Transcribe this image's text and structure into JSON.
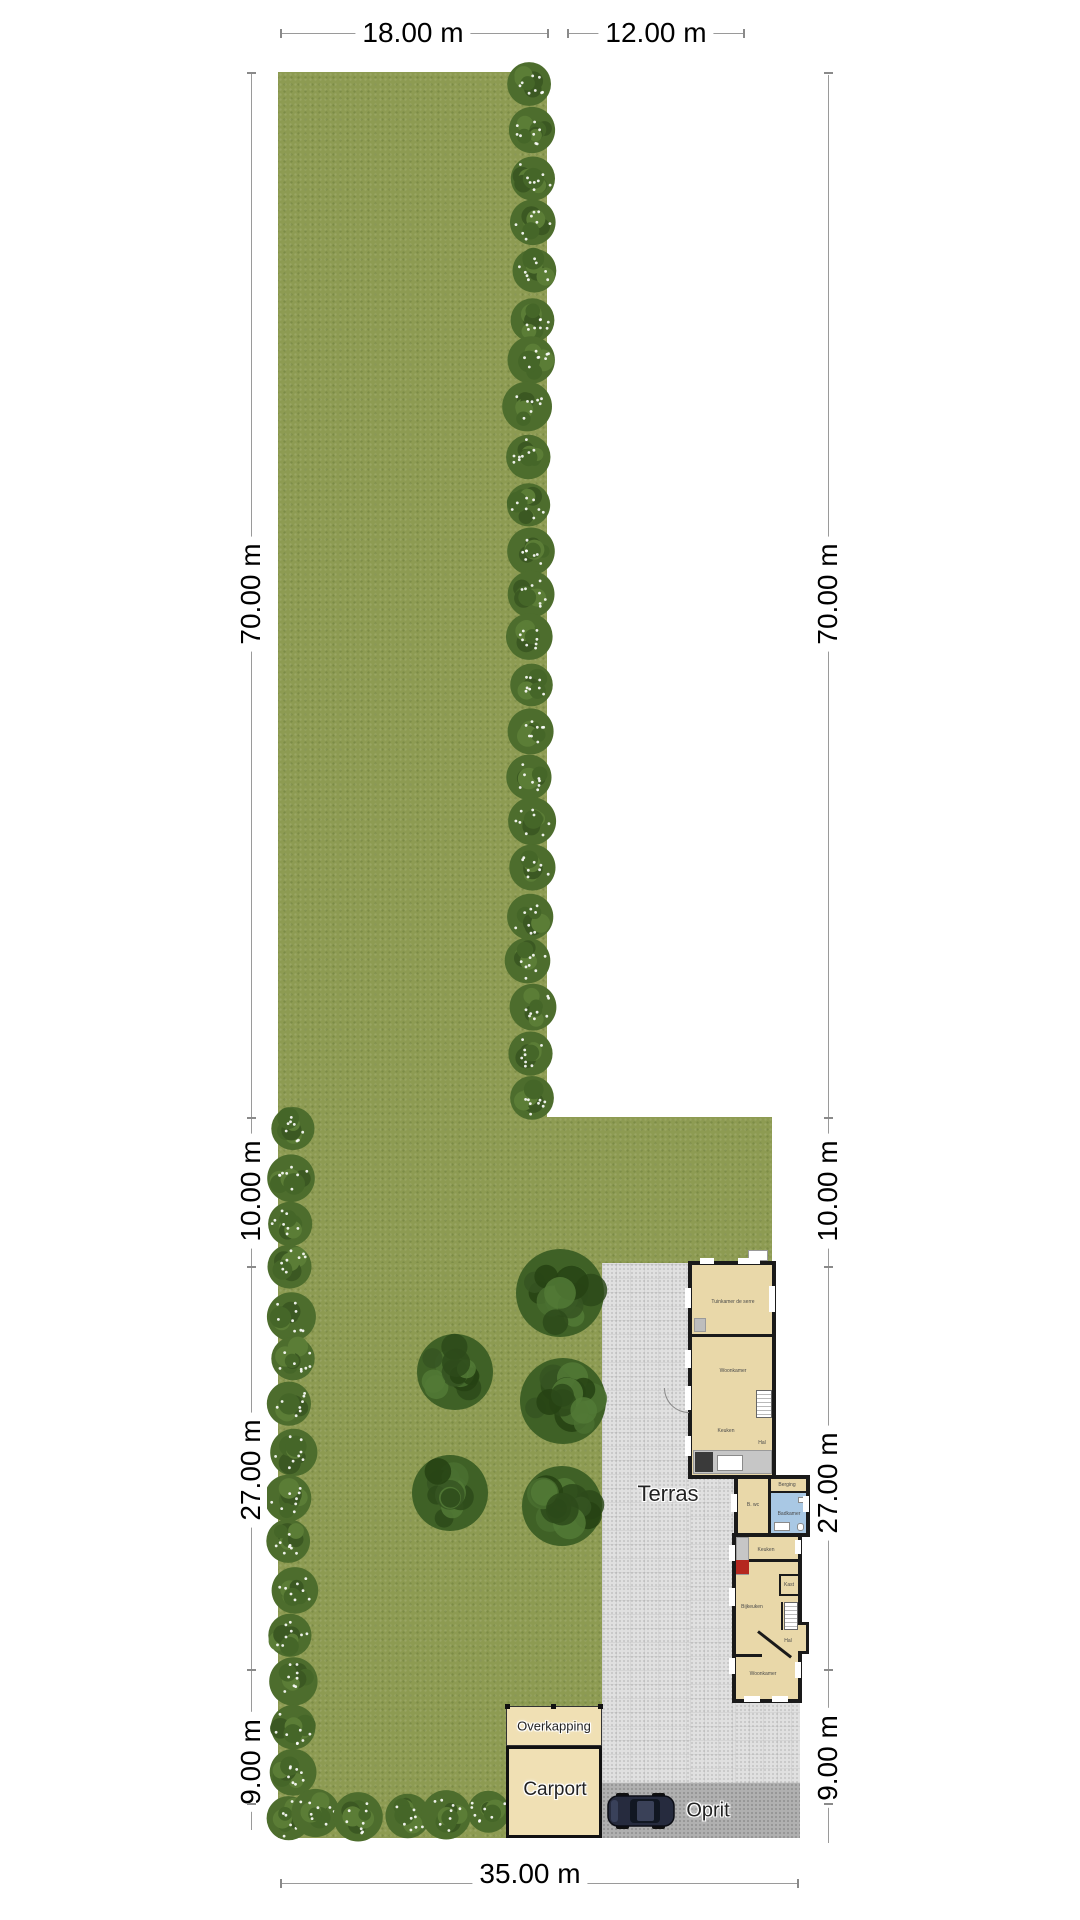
{
  "dimensions": {
    "top": [
      {
        "text": "18.00 m",
        "cx": 413,
        "cy": 33
      },
      {
        "text": "12.00 m",
        "cx": 656,
        "cy": 33
      }
    ],
    "left": [
      {
        "text": "70.00 m",
        "cx": 251,
        "cy": 594
      },
      {
        "text": "10.00 m",
        "cx": 251,
        "cy": 1191
      },
      {
        "text": "27.00 m",
        "cx": 251,
        "cy": 1470
      },
      {
        "text": "9.00 m",
        "cx": 251,
        "cy": 1762
      }
    ],
    "right": [
      {
        "text": "70.00 m",
        "cx": 828,
        "cy": 594
      },
      {
        "text": "10.00 m",
        "cx": 828,
        "cy": 1191
      },
      {
        "text": "27.00 m",
        "cx": 828,
        "cy": 1483
      },
      {
        "text": "9.00 m",
        "cx": 828,
        "cy": 1758
      }
    ],
    "bottom": [
      {
        "text": "35.00 m",
        "cx": 530,
        "cy": 1874
      }
    ]
  },
  "areas": {
    "terras": {
      "text": "Terras",
      "cx": 668,
      "cy": 1494,
      "size": 22
    },
    "oprit": {
      "text": "Oprit",
      "cx": 708,
      "cy": 1811,
      "size": 20
    },
    "carport": {
      "text": "Carport",
      "cx": 555,
      "cy": 1790,
      "size": 19
    },
    "overkapping": {
      "text": "Overkapping",
      "cx": 554,
      "cy": 1726,
      "size": 13
    }
  },
  "house": {
    "rooms": [
      {
        "label": "Tuinkamer de serre",
        "cx": 733,
        "cy": 1302,
        "wrap": true,
        "w": 46
      },
      {
        "label": "Woonkamer",
        "cx": 733,
        "cy": 1371
      },
      {
        "label": "Keuken",
        "cx": 726,
        "cy": 1431
      },
      {
        "label": "Hal",
        "cx": 762,
        "cy": 1443
      },
      {
        "label": "Berging",
        "cx": 787,
        "cy": 1485
      },
      {
        "label": "B. wc",
        "cx": 753,
        "cy": 1505
      },
      {
        "label": "Badkamer",
        "cx": 789,
        "cy": 1514
      },
      {
        "label": "Keuken",
        "cx": 766,
        "cy": 1550
      },
      {
        "label": "Kast",
        "cx": 789,
        "cy": 1585
      },
      {
        "label": "Bijkeuken",
        "cx": 752,
        "cy": 1607
      },
      {
        "label": "Hal",
        "cx": 788,
        "cy": 1641
      },
      {
        "label": "Woonkamer",
        "cx": 763,
        "cy": 1674
      }
    ]
  },
  "landscape": {
    "trees": [
      {
        "cx": 560,
        "cy": 1293,
        "r": 44
      },
      {
        "cx": 455,
        "cy": 1372,
        "r": 38
      },
      {
        "cx": 563,
        "cy": 1401,
        "r": 43
      },
      {
        "cx": 450,
        "cy": 1493,
        "r": 38
      },
      {
        "cx": 562,
        "cy": 1506,
        "r": 40
      }
    ],
    "hedgerows": [
      {
        "x": 531,
        "y": 88,
        "dx": 0,
        "dy": 46,
        "count": 23
      },
      {
        "x": 291,
        "y": 1131,
        "dx": 0,
        "dy": 46,
        "count": 16
      },
      {
        "x": 316,
        "y": 1813,
        "dx": 44,
        "dy": 0,
        "count": 5
      }
    ]
  },
  "vehicle": {
    "type": "car-top-view"
  },
  "colors": {
    "grass": "#8d9b52",
    "terras": "#e0e0e0",
    "oprit": "#b0b0b0",
    "wall": "#1a1a1a",
    "room_fill": "#e9d8a9",
    "bath_fill": "#a9c8e4",
    "carport_fill": "#f0e0b4",
    "tree": "#3f6126",
    "hedge": "#4d6d2d",
    "dim_text": "#000000"
  }
}
